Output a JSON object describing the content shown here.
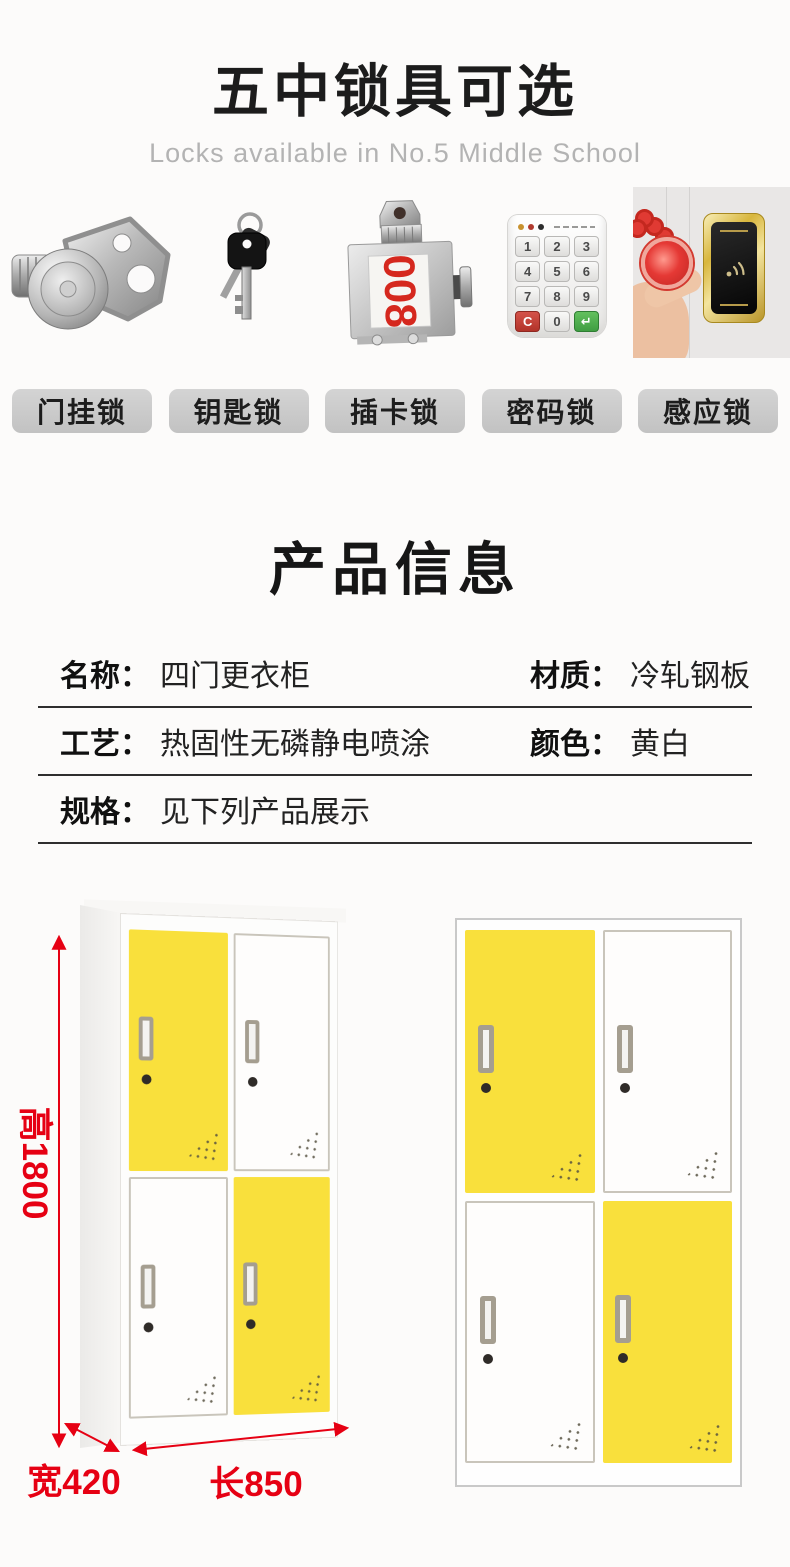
{
  "header": {
    "title": "五中锁具可选",
    "subtitle": "Locks available in No.5 Middle School"
  },
  "locks": {
    "items": [
      {
        "label": "门挂锁",
        "icon": "hasp-lock-icon"
      },
      {
        "label": "钥匙锁",
        "icon": "key-lock-icon"
      },
      {
        "label": "插卡锁",
        "icon": "card-lock-icon",
        "display_number": "008"
      },
      {
        "label": "密码锁",
        "icon": "password-lock-icon",
        "keys": [
          "1",
          "2",
          "3",
          "4",
          "5",
          "6",
          "7",
          "8",
          "9",
          "C",
          "0",
          "↵"
        ]
      },
      {
        "label": "感应锁",
        "icon": "induction-lock-icon"
      }
    ]
  },
  "product_info": {
    "title": "产品信息",
    "rows": [
      {
        "label": "名称：",
        "value": "四门更衣柜",
        "label2": "材质：",
        "value2": "冷轧钢板"
      },
      {
        "label": "工艺：",
        "value": "热固性无磷静电喷涂",
        "label2": "颜色：",
        "value2": "黄白"
      },
      {
        "label": "规格：",
        "value": "见下列产品展示"
      }
    ]
  },
  "lockers": {
    "description": "four-door locker, yellow and white doors",
    "dimensions": {
      "height": "高1800",
      "width": "宽420",
      "length": "长850"
    }
  },
  "colors": {
    "door_yellow": "#f9e03c",
    "dimension_red": "#e60013",
    "badge_gray": "#c9c9c9",
    "card_number_red": "#d5281e"
  }
}
